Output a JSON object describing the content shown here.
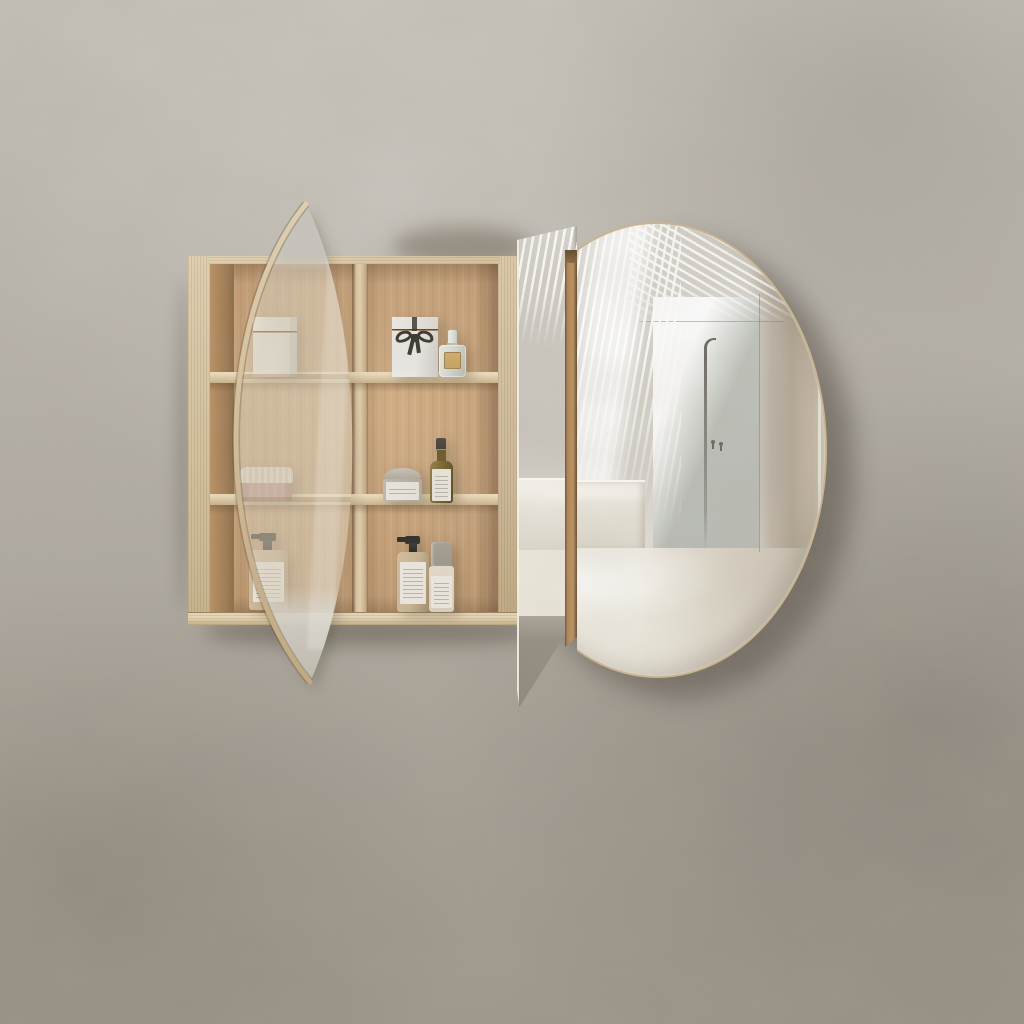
{
  "scene": {
    "type": "product-photograph",
    "subject": "round oak mirror shaving cabinet, wall mounted, mirror door slid open",
    "background": "mottled plaster wall"
  },
  "cabinet": {
    "material": "oak",
    "columns": 2,
    "rows": 3,
    "shelves": 2,
    "items": [
      {
        "name": "white-box",
        "shelf": "top-left",
        "color": "#ebe9e5"
      },
      {
        "name": "gift-box-with-black-ribbon-bow",
        "shelf": "top-right",
        "color": "#ebe9e5",
        "ribbon": "#33302b"
      },
      {
        "name": "perfume-bottle-gold-label",
        "shelf": "top-right",
        "glass": "#d3d7cf",
        "label": "#c7a261"
      },
      {
        "name": "ribbed-jar-pink-body-cream-lid",
        "shelf": "middle-left",
        "body": "#c09b90",
        "lid": "#e7dfd0"
      },
      {
        "name": "glass-jar-with-label",
        "shelf": "middle-right",
        "body": "#b2aba0",
        "lid": "#cac4b7"
      },
      {
        "name": "olive-glass-bottle-black-cap",
        "shelf": "middle-right",
        "body": "#6f5f28",
        "cap": "#38342d"
      },
      {
        "name": "pump-bottle-black-dispenser",
        "shelf": "bottom-left",
        "body": "#c7b192",
        "pump": "#2f2d29"
      },
      {
        "name": "pump-bottle-black-dispenser",
        "shelf": "bottom-right",
        "body": "#c7b192",
        "pump": "#2f2d29"
      },
      {
        "name": "spray-bottle-grey-cap",
        "shelf": "bottom-right",
        "body": "#d9cfbd",
        "cap": "#9a958c"
      }
    ]
  },
  "mirrors": {
    "left_door": {
      "name": "circular-mirror-door-seen-edge-on",
      "rim": "#d9c7a5"
    },
    "middle_panel": {
      "name": "narrow-mirror-panel",
      "bottom": "dark-reflection-wedge"
    },
    "handle_batten": {
      "name": "oak-handle-strip",
      "color": "#b78d5c"
    },
    "right_door": {
      "name": "circular-mirror-door",
      "rim": "#ccb58e",
      "reflection": [
        "louvered-light-stripes",
        "concrete-wall-panel",
        "diagonal-light-beam",
        "freestanding-shower-column",
        "two-wall-hooks",
        "white-bench",
        "bright-floor"
      ]
    }
  },
  "palette": {
    "wall_base": "#b2ada4",
    "wall_light": "#c3bfb6",
    "wall_dark": "#9d968b",
    "wood_edge": "#dccaa9",
    "wood_back": "#c19b73",
    "wood_back_light": "#d2ae85",
    "shelf_edge": "#e3cfac",
    "divider_edge": "#d8c2a0",
    "batten": "#b78d5c",
    "batten_dark": "#6e5130",
    "rim": "#ccb58e",
    "mirror_base": "#d7d4cc",
    "mirror_panel": "#c6c9c2",
    "mirror_band": "#b3a693",
    "mirror_floor": "#ede9dd",
    "mirror_wedge": "#8c857a",
    "pipe": "#6a675f",
    "box_white": "#ebe9e5",
    "ribbon": "#33302b",
    "perfume_gold": "#c7a261",
    "glass": "#d3d7cf",
    "jar_pink": "#c09b90",
    "jar_lid": "#e7dfd0",
    "glassjar": "#b2aba0",
    "glassjar_lid": "#cac4b7",
    "olive": "#6f5f28",
    "cap_dark": "#38342d",
    "pump_black": "#2f2d29",
    "tan_bottle": "#c7b192",
    "label": "#ece8df",
    "spray_cap": "#9a958c",
    "spray_body": "#d9cfbd"
  }
}
